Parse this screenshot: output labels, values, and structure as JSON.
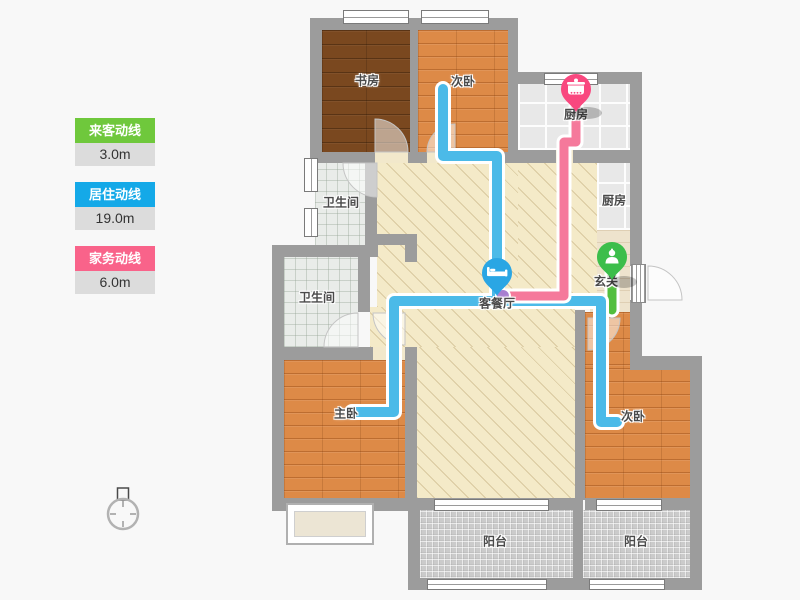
{
  "legend": {
    "items": [
      {
        "id": "visitor-line",
        "label": "来客动线",
        "value": "3.0m",
        "color": "#6fc83c"
      },
      {
        "id": "living-line",
        "label": "居住动线",
        "value": "19.0m",
        "color": "#14a9e8"
      },
      {
        "id": "housework-line",
        "label": "家务动线",
        "value": "6.0m",
        "color": "#f9638a"
      }
    ]
  },
  "plan": {
    "rooms": [
      {
        "id": "study",
        "label": "书房"
      },
      {
        "id": "bedroom2-top",
        "label": "次卧"
      },
      {
        "id": "kitchen",
        "label": "厨房"
      },
      {
        "id": "kitchen-side",
        "label": "厨房"
      },
      {
        "id": "entry",
        "label": "玄关"
      },
      {
        "id": "bath-upper",
        "label": "卫生间"
      },
      {
        "id": "bath-lower",
        "label": "卫生间"
      },
      {
        "id": "living-dining",
        "label": "客餐厅"
      },
      {
        "id": "master-bedroom",
        "label": "主卧"
      },
      {
        "id": "bedroom2-bottom",
        "label": "次卧"
      },
      {
        "id": "balcony-middle",
        "label": "阳台"
      },
      {
        "id": "balcony-right",
        "label": "阳台"
      }
    ],
    "pins": [
      {
        "id": "cooking-marker",
        "icon": "pot-icon",
        "color": "#f9487f"
      },
      {
        "id": "rest-marker",
        "icon": "bed-icon",
        "color": "#2aa6e4"
      },
      {
        "id": "entrance-marker",
        "icon": "person-icon",
        "color": "#3cbe4b"
      }
    ],
    "lines": [
      {
        "id": "visitor-path",
        "color": "#52be3e"
      },
      {
        "id": "living-path",
        "color": "#4bbae8"
      },
      {
        "id": "housework-path",
        "color": "#f5799b"
      }
    ],
    "compass": {
      "id": "north-compass"
    }
  }
}
